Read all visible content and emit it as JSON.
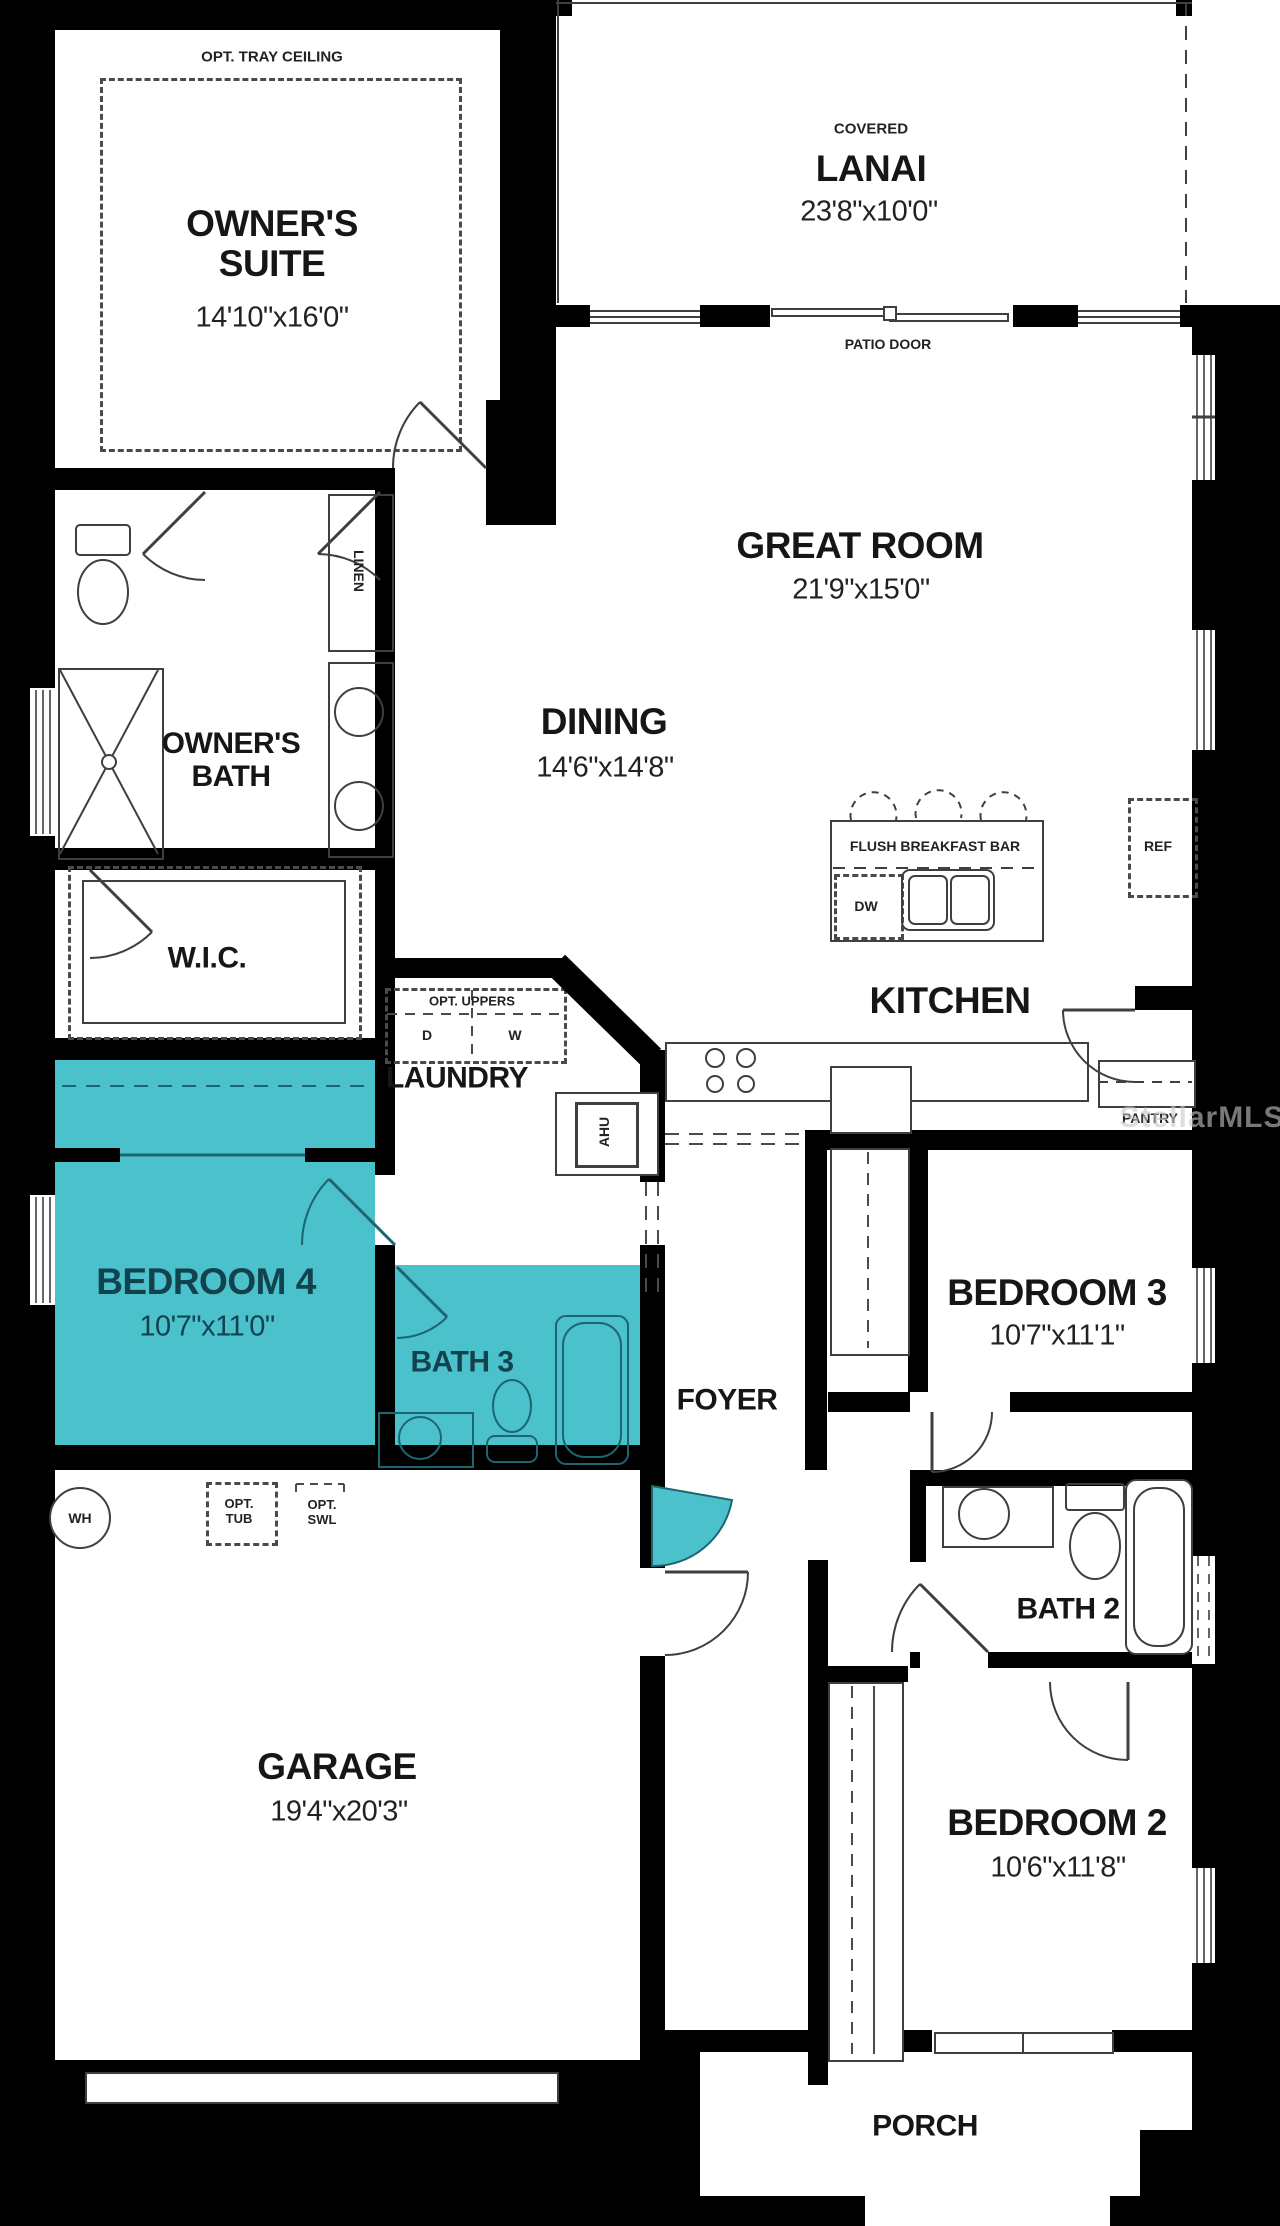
{
  "watermark": "StellarMLS",
  "colors": {
    "wall": "#000000",
    "floor": "#ffffff",
    "highlight": "#4ac1cb",
    "highlight_text": "#12424e",
    "linework": "#3f3f3f",
    "label": "#161616"
  },
  "rooms": {
    "owners_suite": {
      "name": "OWNER'S SUITE",
      "dims": "14'10\"x16'0\"",
      "ceiling_note": "OPT. TRAY CEILING"
    },
    "lanai": {
      "qualifier": "COVERED",
      "name": "LANAI",
      "dims": "23'8\"x10'0\""
    },
    "great_room": {
      "name": "GREAT ROOM",
      "dims": "21'9\"x15'0\""
    },
    "dining": {
      "name": "DINING",
      "dims": "14'6\"x14'8\""
    },
    "kitchen": {
      "name": "KITCHEN"
    },
    "owners_bath": {
      "name": "OWNER'S BATH"
    },
    "wic": {
      "name": "W.I.C."
    },
    "laundry": {
      "name": "LAUNDRY"
    },
    "bedroom4": {
      "name": "BEDROOM 4",
      "dims": "10'7\"x11'0\""
    },
    "bath3": {
      "name": "BATH 3"
    },
    "foyer": {
      "name": "FOYER"
    },
    "bedroom3": {
      "name": "BEDROOM 3",
      "dims": "10'7\"x11'1\""
    },
    "bath2": {
      "name": "BATH 2"
    },
    "bedroom2": {
      "name": "BEDROOM 2",
      "dims": "10'6\"x11'8\""
    },
    "garage": {
      "name": "GARAGE",
      "dims": "19'4\"x20'3\""
    },
    "porch": {
      "name": "PORCH"
    }
  },
  "labels": {
    "patio_door": "PATIO DOOR",
    "linen": "LINEN",
    "flush_breakfast_bar": "FLUSH BREAKFAST BAR",
    "dishwasher": "DW",
    "refrigerator": "REF",
    "pantry": "PANTRY",
    "opt_uppers": "OPT. UPPERS",
    "dryer": "D",
    "washer": "W",
    "air_handler": "AHU",
    "water_heater": "WH",
    "opt_tub": "OPT. TUB",
    "opt_swl": "OPT. SWL"
  }
}
